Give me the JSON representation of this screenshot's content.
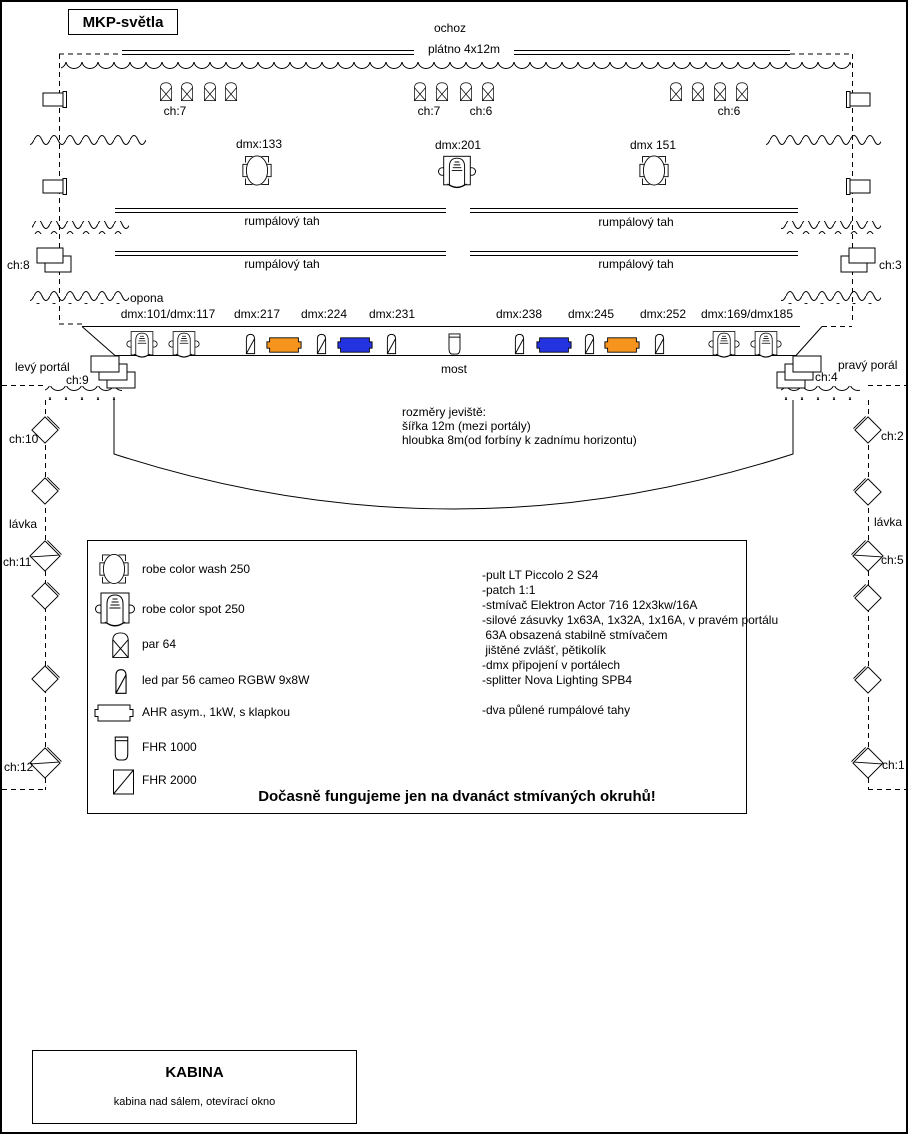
{
  "title": "MKP-světla",
  "colors": {
    "orange": "#F7941E",
    "blue": "#2433E0"
  },
  "top_area": {
    "ochoz_label": "ochoz",
    "platno_label": "plátno 4x12m",
    "group_labels": [
      "ch:7",
      "ch:7",
      "ch:6",
      "ch:6"
    ]
  },
  "mid": {
    "heads": [
      {
        "label": "dmx:133"
      },
      {
        "label": "dmx:201"
      },
      {
        "label": "dmx 151"
      }
    ],
    "rumpal_label": "rumpálový tah",
    "opona_label": "opona",
    "side_channels": {
      "left": "ch:8",
      "right": "ch:3"
    }
  },
  "bridge": {
    "dmx_labels": [
      "dmx:101/dmx:117",
      "dmx:217",
      "dmx:224",
      "dmx:231",
      "dmx:238",
      "dmx:245",
      "dmx:252",
      "dmx:169/dmx185"
    ],
    "most_label": "most",
    "left_portal": "levý portál",
    "right_portal": "pravý porál",
    "ch_left": "ch:9",
    "ch_right": "ch:4"
  },
  "stage": {
    "dims": [
      "rozměry jeviště:",
      "šířka 12m (mezi portály)",
      "hloubka 8m(od forbíny k zadnímu horizontu)"
    ]
  },
  "lavka": {
    "left": {
      "top_ch": "ch:10",
      "label": "lávka",
      "mid_ch": "ch:11",
      "bottom_ch": "ch:12"
    },
    "right": {
      "top_ch": "ch:2",
      "label": "lávka",
      "mid_ch": "ch:5",
      "bottom_ch": "ch:1"
    }
  },
  "legend": {
    "items": [
      {
        "name": "robe color wash 250"
      },
      {
        "name": "robe color spot 250"
      },
      {
        "name": "par 64"
      },
      {
        "name": "led par 56 cameo RGBW 9x8W"
      },
      {
        "name": "AHR asym., 1kW, s klapkou"
      },
      {
        "name": "FHR 1000"
      },
      {
        "name": "FHR 2000"
      }
    ],
    "notes": [
      "-pult LT Piccolo 2 S24",
      "-patch 1:1",
      "-stmívač Elektron Actor 716 12x3kw/16A",
      "-silové zásuvky 1x63A, 1x32A, 1x16A, v pravém portálu",
      " 63A obsazená stabilně stmívačem",
      " jištěné zvlášť, pětikolík",
      "-dmx připojení v portálech",
      "-splitter Nova Lighting SPB4",
      "",
      "-dva půlené rumpálové tahy"
    ],
    "warning": "Dočasně fungujeme jen na dvanáct stmívaných okruhů!"
  },
  "kabina": {
    "title": "KABINA",
    "subtitle": "kabina nad sálem, otevírací okno"
  }
}
